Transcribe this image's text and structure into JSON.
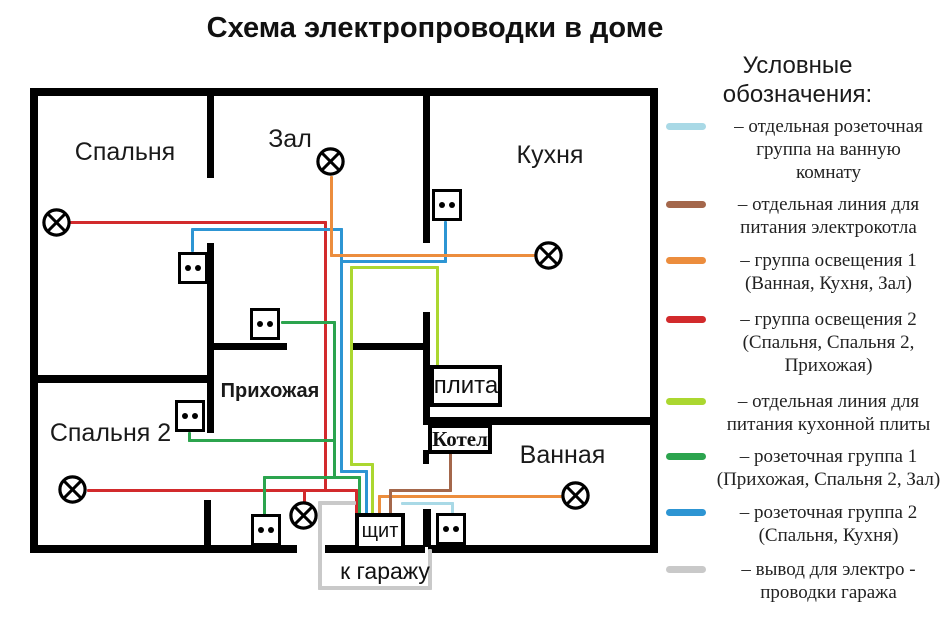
{
  "title": "Схема электропроводки в доме",
  "colors": {
    "light_blue": "#a9d9e6",
    "brown": "#a4674b",
    "orange": "#ec8d3d",
    "red": "#d22a2c",
    "yellow_green": "#abd730",
    "green": "#2ca44e",
    "blue": "#2d95d3",
    "gray": "#c9c9c9"
  },
  "plan": {
    "rooms": [
      {
        "id": "spalnya",
        "label": "Спальня"
      },
      {
        "id": "zal",
        "label": "Зал"
      },
      {
        "id": "kuhnya",
        "label": "Кухня"
      },
      {
        "id": "prihozhaya",
        "label": "Прихожая"
      },
      {
        "id": "spalnya2",
        "label": "Спальня 2"
      },
      {
        "id": "vannaya",
        "label": "Ванная"
      }
    ],
    "devices": {
      "stove_label": "плита",
      "boiler_label": "Котел",
      "panel_label": "щит",
      "garage_label": "к гаражу"
    }
  },
  "legend": {
    "title": "Условные\nобозначения:",
    "items": [
      {
        "color_key": "light_blue",
        "label": "– отдельная розеточная\nгруппа на ванную\nкомнату"
      },
      {
        "color_key": "brown",
        "label": "– отдельная линия для\nпитания электрокотла"
      },
      {
        "color_key": "orange",
        "label": "– группа освещения 1\n(Ванная, Кухня, Зал)"
      },
      {
        "color_key": "red",
        "label": "– группа освещения 2\n(Спальня, Спальня 2,\nПрихожая)"
      },
      {
        "color_key": "yellow_green",
        "label": "– отдельная линия для\nпитания кухонной плиты"
      },
      {
        "color_key": "green",
        "label": "– розеточная группа 1\n(Прихожая, Спальня 2, Зал)"
      },
      {
        "color_key": "blue",
        "label": "– розеточная группа 2\n(Спальня, Кухня)"
      },
      {
        "color_key": "gray",
        "label": "– вывод для электро -\nпроводки гаража"
      }
    ]
  }
}
